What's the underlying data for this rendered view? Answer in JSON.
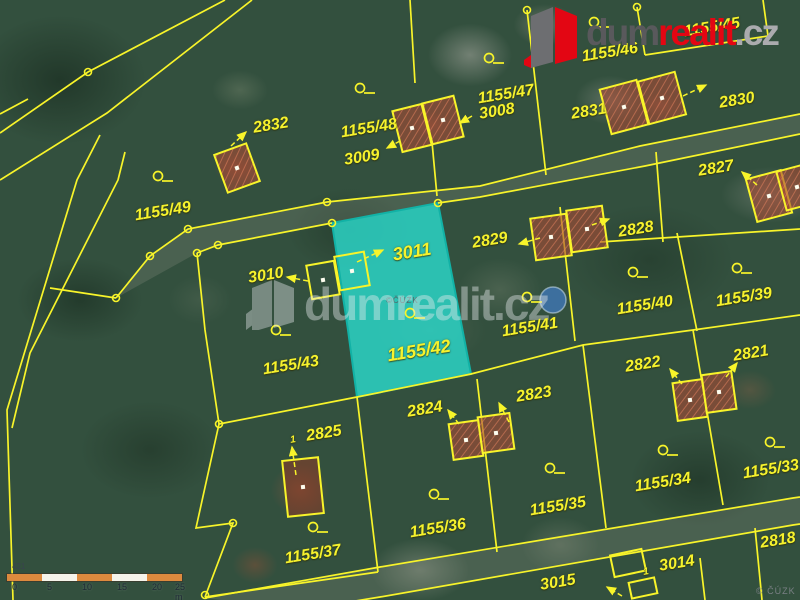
{
  "logo": {
    "dum": "dum",
    "realit": "realit",
    "cz": ".cz"
  },
  "watermark": {
    "text": "dumrealit.cz",
    "copyright_center": "©ČÚZK",
    "copyright_corner": "© ČÚZK"
  },
  "scalebar": {
    "note": "421",
    "ticks": [
      "0",
      "5",
      "10",
      "15",
      "20",
      "25 m"
    ],
    "tick_x": [
      5,
      40,
      75,
      110,
      145,
      168
    ],
    "segment_colors": [
      "#dd8a3e",
      "#f5f3ea",
      "#dd8a3e",
      "#f5f3ea",
      "#dd8a3e"
    ]
  },
  "map": {
    "line_color": "#f8f42a",
    "highlight_fill": "rgba(43,211,197,0.85)",
    "highlight_stroke": "#12b2a6",
    "building_fill": "rgba(168,74,52,0.60)",
    "roof_fill": "rgba(152,56,36,0.50)",
    "road_fill": "rgba(138,145,128,0.28)",
    "pool": {
      "x": 553,
      "y": 300,
      "r": 13
    },
    "highlight_parcel": {
      "points": [
        [
          332,
          223
        ],
        [
          438,
          203
        ],
        [
          471,
          374
        ],
        [
          357,
          397
        ],
        [
          348,
          330
        ]
      ]
    },
    "road_fills": [
      [
        [
          116,
          298
        ],
        [
          150,
          256
        ],
        [
          188,
          229
        ],
        [
          327,
          202
        ],
        [
          480,
          186
        ],
        [
          640,
          146
        ],
        [
          800,
          114
        ],
        [
          800,
          134
        ],
        [
          645,
          166
        ],
        [
          480,
          197
        ],
        [
          438,
          203
        ],
        [
          332,
          223
        ],
        [
          218,
          245
        ],
        [
          197,
          253
        ]
      ],
      [
        [
          205,
          598
        ],
        [
          380,
          567
        ],
        [
          793,
          498
        ],
        [
          800,
          497
        ],
        [
          800,
          524
        ],
        [
          793,
          525
        ],
        [
          380,
          597
        ],
        [
          300,
          610
        ]
      ]
    ],
    "boundary_lines": [
      [
        [
          225,
          0
        ],
        [
          88,
          72
        ],
        [
          0,
          133
        ]
      ],
      [
        [
          252,
          0
        ],
        [
          107,
          113
        ],
        [
          0,
          180
        ]
      ],
      [
        [
          100,
          135
        ],
        [
          77,
          180
        ],
        [
          7,
          410
        ],
        [
          13,
          600
        ]
      ],
      [
        [
          125,
          152
        ],
        [
          118,
          180
        ],
        [
          30,
          353
        ],
        [
          12,
          428
        ]
      ],
      [
        [
          0,
          114
        ],
        [
          28,
          99
        ]
      ],
      [
        [
          50,
          288
        ],
        [
          116,
          298
        ]
      ],
      [
        [
          116,
          298
        ],
        [
          150,
          256
        ],
        [
          188,
          229
        ],
        [
          327,
          202
        ],
        [
          480,
          186
        ],
        [
          640,
          146
        ],
        [
          800,
          114
        ]
      ],
      [
        [
          197,
          253
        ],
        [
          218,
          245
        ],
        [
          332,
          223
        ]
      ],
      [
        [
          438,
          203
        ],
        [
          480,
          197
        ],
        [
          645,
          166
        ],
        [
          800,
          134
        ]
      ],
      [
        [
          197,
          253
        ],
        [
          205,
          330
        ],
        [
          219,
          424
        ]
      ],
      [
        [
          219,
          424
        ],
        [
          357,
          397
        ]
      ],
      [
        [
          219,
          424
        ],
        [
          196,
          528
        ],
        [
          233,
          523
        ],
        [
          205,
          597
        ]
      ],
      [
        [
          205,
          597
        ],
        [
          378,
          572
        ]
      ],
      [
        [
          357,
          397
        ],
        [
          378,
          572
        ]
      ],
      [
        [
          357,
          397
        ],
        [
          471,
          374
        ],
        [
          583,
          345
        ],
        [
          693,
          330
        ],
        [
          800,
          315
        ]
      ],
      [
        [
          477,
          379
        ],
        [
          497,
          552
        ]
      ],
      [
        [
          583,
          345
        ],
        [
          606,
          528
        ]
      ],
      [
        [
          560,
          207
        ],
        [
          575,
          341
        ]
      ],
      [
        [
          600,
          242
        ],
        [
          800,
          229
        ]
      ],
      [
        [
          656,
          152
        ],
        [
          663,
          242
        ]
      ],
      [
        [
          677,
          233
        ],
        [
          697,
          331
        ]
      ],
      [
        [
          693,
          330
        ],
        [
          723,
          505
        ]
      ],
      [
        [
          410,
          0
        ],
        [
          415,
          83
        ]
      ],
      [
        [
          432,
          142
        ],
        [
          437,
          196
        ]
      ],
      [
        [
          527,
          10
        ],
        [
          546,
          175
        ]
      ],
      [
        [
          637,
          7
        ],
        [
          645,
          55
        ]
      ],
      [
        [
          645,
          55
        ],
        [
          768,
          36
        ]
      ],
      [
        [
          763,
          0
        ],
        [
          768,
          36
        ]
      ],
      [
        [
          205,
          598
        ],
        [
          380,
          567
        ],
        [
          793,
          498
        ],
        [
          800,
          497
        ]
      ],
      [
        [
          300,
          610
        ],
        [
          380,
          597
        ],
        [
          793,
          525
        ],
        [
          800,
          524
        ]
      ],
      [
        [
          700,
          558
        ],
        [
          705,
          600
        ]
      ],
      [
        [
          755,
          528
        ],
        [
          762,
          600
        ]
      ]
    ],
    "vertex_circles": [
      [
        88,
        72
      ],
      [
        188,
        229
      ],
      [
        150,
        256
      ],
      [
        116,
        298
      ],
      [
        197,
        253
      ],
      [
        218,
        245
      ],
      [
        327,
        202
      ],
      [
        219,
        424
      ],
      [
        332,
        223
      ],
      [
        438,
        203
      ],
      [
        637,
        7
      ],
      [
        527,
        10
      ],
      [
        233,
        523
      ],
      [
        205,
        595
      ]
    ],
    "point_symbols": [
      [
        158,
        176
      ],
      [
        360,
        88
      ],
      [
        489,
        58
      ],
      [
        594,
        22
      ],
      [
        276,
        330
      ],
      [
        410,
        313
      ],
      [
        527,
        297
      ],
      [
        633,
        272
      ],
      [
        737,
        268
      ],
      [
        550,
        468
      ],
      [
        434,
        494
      ],
      [
        313,
        527
      ],
      [
        663,
        450
      ],
      [
        770,
        442
      ]
    ],
    "arrows": [
      [
        231,
        146,
        246,
        132
      ],
      [
        400,
        141,
        387,
        148
      ],
      [
        472,
        116,
        460,
        123
      ],
      [
        683,
        96,
        706,
        85
      ],
      [
        757,
        185,
        742,
        172
      ],
      [
        540,
        238,
        519,
        244
      ],
      [
        592,
        225,
        609,
        219
      ],
      [
        308,
        281,
        287,
        277
      ],
      [
        357,
        262,
        383,
        250
      ],
      [
        459,
        424,
        448,
        410
      ],
      [
        509,
        422,
        499,
        403
      ],
      [
        726,
        377,
        737,
        363
      ],
      [
        682,
        384,
        670,
        369
      ],
      [
        296,
        475,
        292,
        447
      ],
      [
        622,
        596,
        607,
        587
      ]
    ],
    "buildings": [
      {
        "x": 237,
        "y": 168,
        "w": 34,
        "h": 40,
        "r": -20,
        "fill": "hatch",
        "dot": true
      },
      {
        "x": 412,
        "y": 128,
        "w": 30,
        "h": 42,
        "r": -14,
        "fill": "hatch",
        "dot": true
      },
      {
        "x": 443,
        "y": 120,
        "w": 32,
        "h": 42,
        "r": -14,
        "fill": "hatch",
        "dot": true
      },
      {
        "x": 624,
        "y": 107,
        "w": 38,
        "h": 46,
        "r": -15,
        "fill": "hatch",
        "dot": true
      },
      {
        "x": 662,
        "y": 98,
        "w": 38,
        "h": 44,
        "r": -15,
        "fill": "hatch",
        "dot": true
      },
      {
        "x": 769,
        "y": 196,
        "w": 36,
        "h": 44,
        "r": -15,
        "fill": "hatch",
        "dot": true
      },
      {
        "x": 797,
        "y": 187,
        "w": 32,
        "h": 40,
        "r": -15,
        "fill": "hatch",
        "dot": true
      },
      {
        "x": 551,
        "y": 237,
        "w": 36,
        "h": 42,
        "r": -8,
        "fill": "hatch",
        "dot": true
      },
      {
        "x": 587,
        "y": 229,
        "w": 36,
        "h": 42,
        "r": -8,
        "fill": "hatch",
        "dot": true
      },
      {
        "x": 466,
        "y": 440,
        "w": 30,
        "h": 36,
        "r": -8,
        "fill": "hatch",
        "dot": true
      },
      {
        "x": 496,
        "y": 433,
        "w": 32,
        "h": 36,
        "r": -8,
        "fill": "hatch",
        "dot": true
      },
      {
        "x": 690,
        "y": 400,
        "w": 30,
        "h": 38,
        "r": -8,
        "fill": "hatch",
        "dot": true
      },
      {
        "x": 719,
        "y": 392,
        "w": 30,
        "h": 38,
        "r": -8,
        "fill": "hatch",
        "dot": true
      },
      {
        "x": 323,
        "y": 280,
        "w": 28,
        "h": 34,
        "r": -10,
        "fill": "none",
        "dot": true
      },
      {
        "x": 352,
        "y": 271,
        "w": 30,
        "h": 34,
        "r": -10,
        "fill": "none",
        "dot": true
      },
      {
        "x": 303,
        "y": 487,
        "w": 36,
        "h": 56,
        "r": -6,
        "fill": "roof",
        "dot": true
      },
      {
        "x": 628,
        "y": 563,
        "w": 32,
        "h": 22,
        "r": -12,
        "fill": "none",
        "dot": false
      },
      {
        "x": 643,
        "y": 588,
        "w": 26,
        "h": 16,
        "r": -12,
        "fill": "none",
        "dot": false
      }
    ],
    "parcel_labels": [
      {
        "t": "2832",
        "x": 271,
        "y": 126
      },
      {
        "t": "1155/48",
        "x": 369,
        "y": 129
      },
      {
        "t": "3009",
        "x": 362,
        "y": 158
      },
      {
        "t": "1155/47",
        "x": 506,
        "y": 95
      },
      {
        "t": "3008",
        "x": 497,
        "y": 112
      },
      {
        "t": "2831",
        "x": 589,
        "y": 112
      },
      {
        "t": "1155/46",
        "x": 610,
        "y": 53
      },
      {
        "t": "1155/45",
        "x": 712,
        "y": 28
      },
      {
        "t": "2830",
        "x": 737,
        "y": 101
      },
      {
        "t": "2827",
        "x": 716,
        "y": 169
      },
      {
        "t": "1155/49",
        "x": 163,
        "y": 212
      },
      {
        "t": "2829",
        "x": 490,
        "y": 241
      },
      {
        "t": "2828",
        "x": 636,
        "y": 230
      },
      {
        "t": "3010",
        "x": 266,
        "y": 276
      },
      {
        "t": "3011",
        "x": 412,
        "y": 252,
        "fs": 18
      },
      {
        "t": "1155/40",
        "x": 645,
        "y": 306
      },
      {
        "t": "1155/39",
        "x": 744,
        "y": 298
      },
      {
        "t": "1155/41",
        "x": 530,
        "y": 328
      },
      {
        "t": "1155/42",
        "x": 419,
        "y": 351,
        "fs": 18
      },
      {
        "t": "1155/43",
        "x": 291,
        "y": 366
      },
      {
        "t": "2822",
        "x": 643,
        "y": 365
      },
      {
        "t": "2821",
        "x": 751,
        "y": 354
      },
      {
        "t": "2823",
        "x": 534,
        "y": 395
      },
      {
        "t": "2824",
        "x": 425,
        "y": 410
      },
      {
        "t": "2825",
        "x": 324,
        "y": 434
      },
      {
        "t": "1155/34",
        "x": 663,
        "y": 483
      },
      {
        "t": "1155/33",
        "x": 771,
        "y": 470
      },
      {
        "t": "1155/35",
        "x": 558,
        "y": 507
      },
      {
        "t": "1155/36",
        "x": 438,
        "y": 529
      },
      {
        "t": "1155/37",
        "x": 313,
        "y": 555
      },
      {
        "t": "2818",
        "x": 778,
        "y": 541
      },
      {
        "t": "3014",
        "x": 677,
        "y": 564
      },
      {
        "t": "3015",
        "x": 558,
        "y": 583
      },
      {
        "t": "1",
        "x": 293,
        "y": 440,
        "fs": 10
      },
      {
        "t": "1",
        "x": 646,
        "y": 572,
        "fs": 10
      }
    ]
  }
}
